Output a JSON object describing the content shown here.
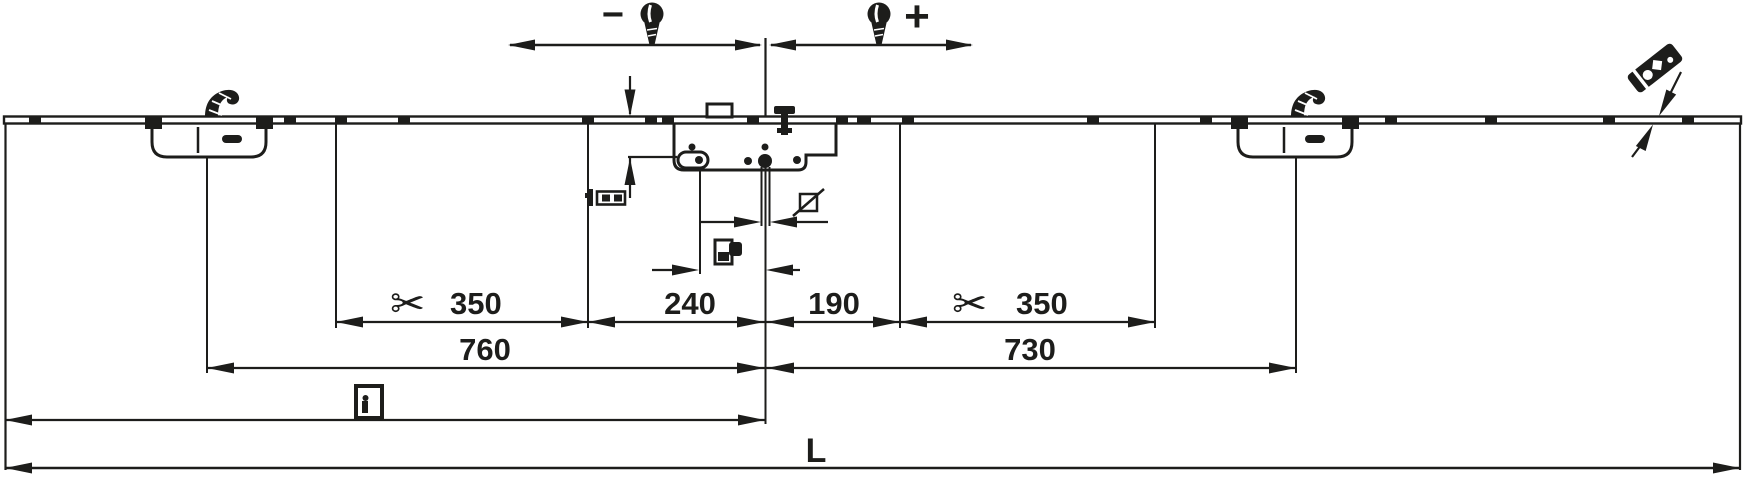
{
  "adjustment": {
    "minus": "−",
    "plus": "+"
  },
  "dimensions": {
    "left_cut": "350",
    "left_center": "240",
    "right_center": "190",
    "right_cut": "350",
    "left_span": "760",
    "right_span": "730",
    "total_length": "L"
  },
  "icons": {
    "scissors": "✂",
    "screw": "slotted-screw-shape",
    "square_section": "slashed-square-symbol",
    "door": "door-leaf-symbol",
    "profile": "faceplate-profile-symbol",
    "follower": "handle-follower-symbol",
    "section_plate": "drilled-plate-symbol",
    "mushroom_cam": "locking-cam-shape"
  },
  "colors": {
    "ink": "#1d1d1b",
    "background": "#ffffff"
  }
}
